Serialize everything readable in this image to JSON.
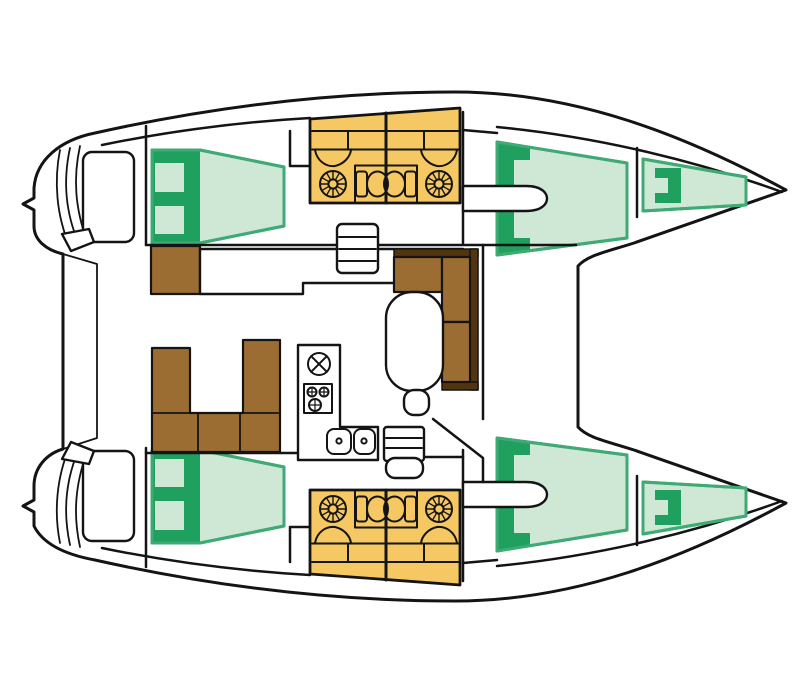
{
  "page": {
    "title": "Catamaran interior floor plan",
    "description": "Top-down deck layout of a 4-cabin catamaran with two forepeak berths, four bathrooms, salon and galley"
  },
  "colors": {
    "page_bg": "#ffffff",
    "outline": "#141414",
    "hull_fill": "#ffffff",
    "cabin_fill": "#cfe8d5",
    "cabin_border": "#3faa74",
    "cabin_dark": "#1fa05f",
    "bathroom_fill": "#f5c863",
    "wood_fill": "#9c6d33",
    "wood_dark": "#503510"
  },
  "areas": {
    "hull": "Catamaran hull outline",
    "transom": "Transom steps and swim platform",
    "aft_cabin": "Double berth cabin (aft)",
    "fwd_cabin": "Double berth cabin (forward)",
    "forepeak": "Forepeak berth",
    "bathroom": "Bathroom head compartment",
    "fan": "Shower drain grate",
    "toilet": "Toilet",
    "basin": "Washbasin",
    "salon_sofa": "U-shaped salon sofa",
    "chaise": "L-shaped lounge seat",
    "table": "Salon table",
    "stool": "Seat",
    "chart_desk": "Chart desk sideboard",
    "nav_seat": "Navigation seat",
    "galley": "Galley counter",
    "stove": "Stove burners",
    "hatch": "Deck hatch",
    "sinks": "Galley sinks",
    "companionway": "Companionway steps",
    "hull_steps": "Hull access steps",
    "entry": "Cabin entry walkway"
  }
}
